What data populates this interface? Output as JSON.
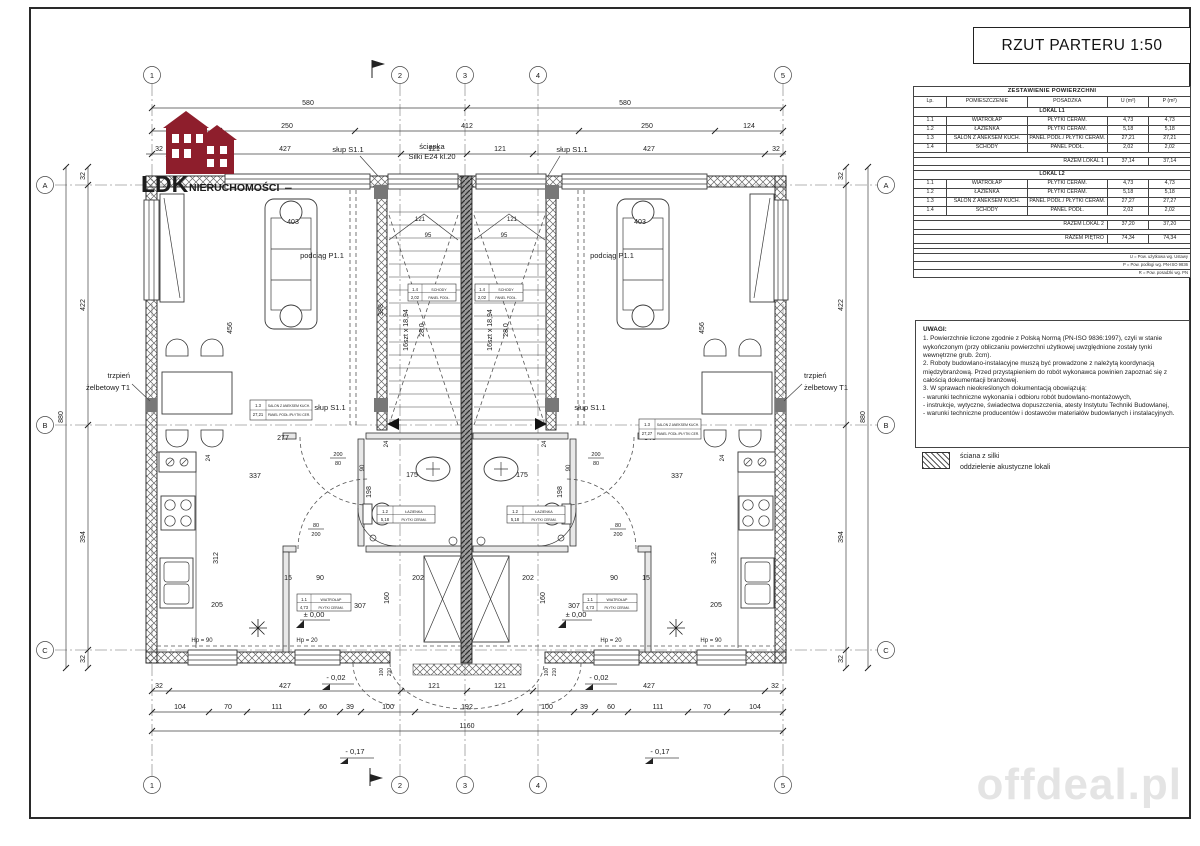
{
  "sheet": {
    "title": "RZUT PARTERU  1:50"
  },
  "logo": {
    "brand": "LDK",
    "brand_suffix": "NIERUCHOMOŚCI",
    "dash": "–"
  },
  "watermark": "offdeal.pl",
  "area_table": {
    "title": "ZESTAWIENIE POWIERZCHNI",
    "columns": [
      "Lp.",
      "POMIESZCZENIE",
      "POSADZKA",
      "U (m²)",
      "P (m²)"
    ],
    "locals": [
      {
        "name": "LOKAL L1",
        "rows": [
          {
            "lp": "1.1",
            "room": "WIATROŁAP",
            "floor": "PŁYTKI CERAM.",
            "u": "4,73",
            "p": "4,73"
          },
          {
            "lp": "1.2",
            "room": "ŁAZIENKA",
            "floor": "PŁYTKI CERAM.",
            "u": "5,18",
            "p": "5,18"
          },
          {
            "lp": "1.3",
            "room": "SALON Z ANEKSEM KUCH.",
            "floor": "PANEL PODŁ./ PŁYTKI CERAM.",
            "u": "27,21",
            "p": "27,21"
          },
          {
            "lp": "1.4",
            "room": "SCHODY",
            "floor": "PANEL PODŁ.",
            "u": "2,02",
            "p": "2,02"
          }
        ],
        "total_label": "RAZEM LOKAL 1",
        "total_u": "37,14",
        "total_p": "37,14"
      },
      {
        "name": "LOKAL L2",
        "rows": [
          {
            "lp": "1.1",
            "room": "WIATROŁAP",
            "floor": "PŁYTKI CERAM.",
            "u": "4,73",
            "p": "4,73"
          },
          {
            "lp": "1.2",
            "room": "ŁAZIENKA",
            "floor": "PŁYTKI CERAM.",
            "u": "5,18",
            "p": "5,18"
          },
          {
            "lp": "1.3",
            "room": "SALON Z ANEKSEM KUCH.",
            "floor": "PANEL PODŁ./ PŁYTKI CERAM.",
            "u": "27,27",
            "p": "27,27"
          },
          {
            "lp": "1.4",
            "room": "SCHODY",
            "floor": "PANEL PODŁ.",
            "u": "2,02",
            "p": "2,02"
          }
        ],
        "total_label": "RAZEM LOKAL 2",
        "total_u": "37,20",
        "total_p": "37,20"
      }
    ],
    "grand_label": "RAZEM PIĘTRO",
    "grand_u": "74,34",
    "grand_p": "74,34",
    "footnotes": [
      "U = Pow. użytkowa wg. Ustawy",
      "P = Pow. podłogi wg. PN-ISO 9836",
      "R = Pow. posadzki wg. PN"
    ]
  },
  "notes": {
    "title": "UWAGI:",
    "items": [
      "1.  Powierzchnie liczone zgodnie z Polską Normą (PN-ISO 9836:1997), czyli w stanie wykończonym (przy obliczaniu powierzchni użytkowej uwzględnione zostały tynki wewnętrzne grub. 2cm).",
      "2.  Roboty budowlano-instalacyjne muszą być prowadzone z należytą koordynacją międzybranżową. Przed przystąpieniem do robót wykonawca powinien zapoznać się z całością dokumentacji branżowej.",
      "3.  W sprawach nieokreślonych dokumentacją obowiązują:",
      "-   warunki techniczne wykonania i odbioru robót budowlano-montażowych,",
      "-   instrukcje, wytyczne, świadectwa dopuszczenia, atesty Instytutu Techniki Budowlanej,",
      "-   warunki techniczne producentów i dostawców materiałów budowlanych i instalacyjnych."
    ]
  },
  "legend": {
    "line1": "ściana z silki",
    "line2": "oddzielenie akustyczne lokali"
  },
  "plan": {
    "grid_cols": [
      "1",
      "2",
      "3",
      "4",
      "5"
    ],
    "grid_rows": [
      "A",
      "B",
      "C"
    ],
    "labels": {
      "scianka_1": "ścianka",
      "scianka_2": "Silki E24 kl.20",
      "slup": "słup S1.1",
      "podciag": "podciąg P1.1",
      "trzpien_1": "trzpień",
      "trzpien_2": "żelbetowy T1",
      "lv_0": "± 0,00",
      "lv_m02": "- 0,02",
      "lv_m17": "- 0,17",
      "hp90": "Hp = 90",
      "hp20": "Hp = 20",
      "stair_steps": "16szt x 18,94",
      "stair_tread": "28,0"
    },
    "dims": {
      "15": "15",
      "24": "24",
      "32": "32",
      "39": "39",
      "60": "60",
      "70": "70",
      "80": "80",
      "90": "90",
      "95": "95",
      "100": "100",
      "104": "104",
      "111": "111",
      "121": "121",
      "124": "124",
      "160": "160",
      "175": "175",
      "192": "192",
      "198": "198",
      "200": "200",
      "202": "202",
      "205": "205",
      "210": "210",
      "250": "250",
      "277": "277",
      "307": "307",
      "312": "312",
      "337": "337",
      "343": "343",
      "394": "394",
      "398": "398",
      "403": "403",
      "412": "412",
      "422": "422",
      "427": "427",
      "456": "456",
      "580": "580",
      "880": "880",
      "1160": "1160"
    },
    "tags": {
      "wiatrolap": {
        "no": "1.1",
        "name": "WIATROŁAP",
        "area": "4,73",
        "floor": "PŁYTKI CERAM."
      },
      "lazienka": {
        "no": "1.2",
        "name": "ŁAZIENKA",
        "area": "5,18",
        "floor": "PŁYTKI CERAM."
      },
      "salon_l": {
        "no": "1.3",
        "name": "SALON Z ANEKSEM KUCH.",
        "area": "27,21",
        "floor": "PANEL PODŁ./PŁYTKI CER."
      },
      "salon_r": {
        "no": "1.3",
        "name": "SALON Z ANEKSEM KUCH.",
        "area": "27,27",
        "floor": "PANEL PODŁ./PŁYTKI CER."
      },
      "schody": {
        "no": "1.4",
        "name": "SCHODY",
        "area": "2,02",
        "floor": "PANEL PODŁ."
      }
    }
  }
}
